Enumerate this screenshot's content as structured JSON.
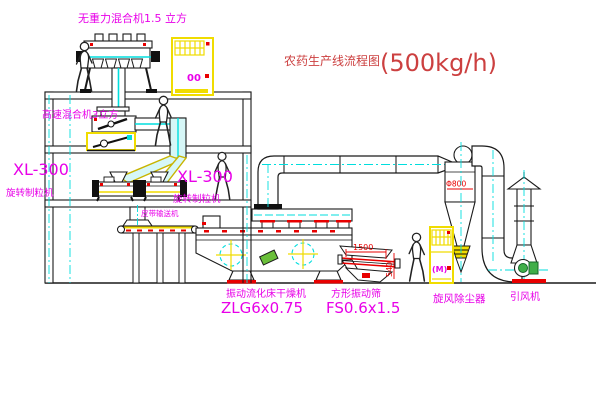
{
  "title": {
    "name": "农药生产线流程图",
    "capacity": "(500kg/h)"
  },
  "equipment": {
    "gravity_mixer": {
      "label": "无重力混合机1.5 立方"
    },
    "high_speed_mixer": {
      "label": "高速混合机3立方"
    },
    "granulator_left": {
      "model": "XL-300",
      "name": "旋转制粒机"
    },
    "granulator_right": {
      "model": "XL-300",
      "name": "旋转制粒机"
    },
    "belt_conveyor": {
      "label": "皮带输送机"
    },
    "fluid_bed_dryer": {
      "name": "振动流化床干燥机",
      "model": "ZLG6x0.75"
    },
    "vibrating_screen": {
      "name": "方形振动筛",
      "model": "FS0.6x1.5"
    },
    "cyclone": {
      "name": "旋风除尘器",
      "dimension": "Φ800"
    },
    "fan": {
      "name": "引风机"
    }
  },
  "dimensions": {
    "screen_length": "1500",
    "screen_height": "540"
  },
  "control_cabinets": {
    "cabinet_top": "00",
    "cabinet_right": "(M)"
  },
  "colors": {
    "line": "#1a1a1a",
    "cad_yellow": "#f0dc00",
    "cad_cyan": "#00dede",
    "cad_magenta": "#e800e8",
    "cad_red": "#e80000",
    "title_red": "#cc4040",
    "fan_green": "#3fae49",
    "background": "#ffffff"
  }
}
